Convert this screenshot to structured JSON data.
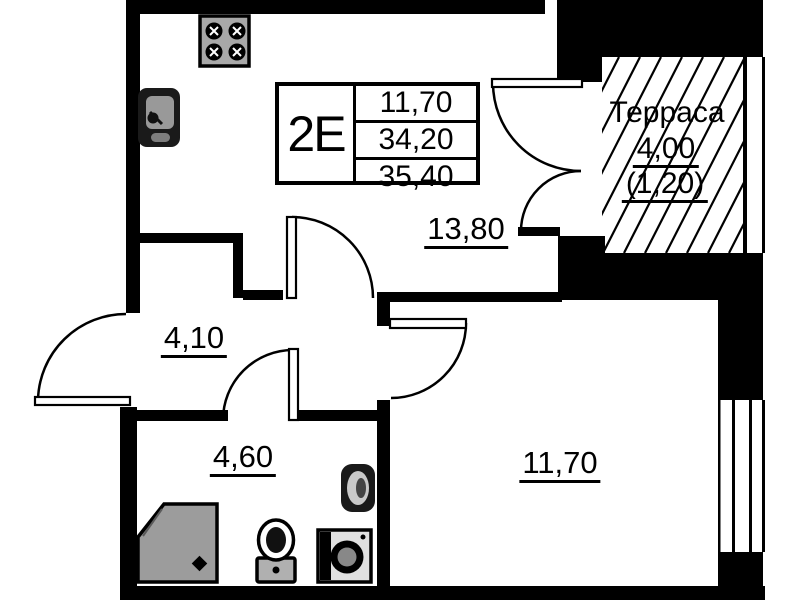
{
  "unit_info": {
    "type": "2Е",
    "living_area": "11,70",
    "total_area": "34,20",
    "total_area_with_terrace": "35,40"
  },
  "room_labels": {
    "kitchen_living": "13,80",
    "hallway": "4,10",
    "bathroom": "4,60",
    "room": "11,70"
  },
  "terrace": {
    "name": "Терраса",
    "area": "4,00",
    "reduced_area": "(1,20)"
  },
  "colors": {
    "walls": "#000000",
    "background": "#ffffff",
    "fixture_gray": "#9c9c9c",
    "fixture_dark": "#1a1a1a"
  }
}
